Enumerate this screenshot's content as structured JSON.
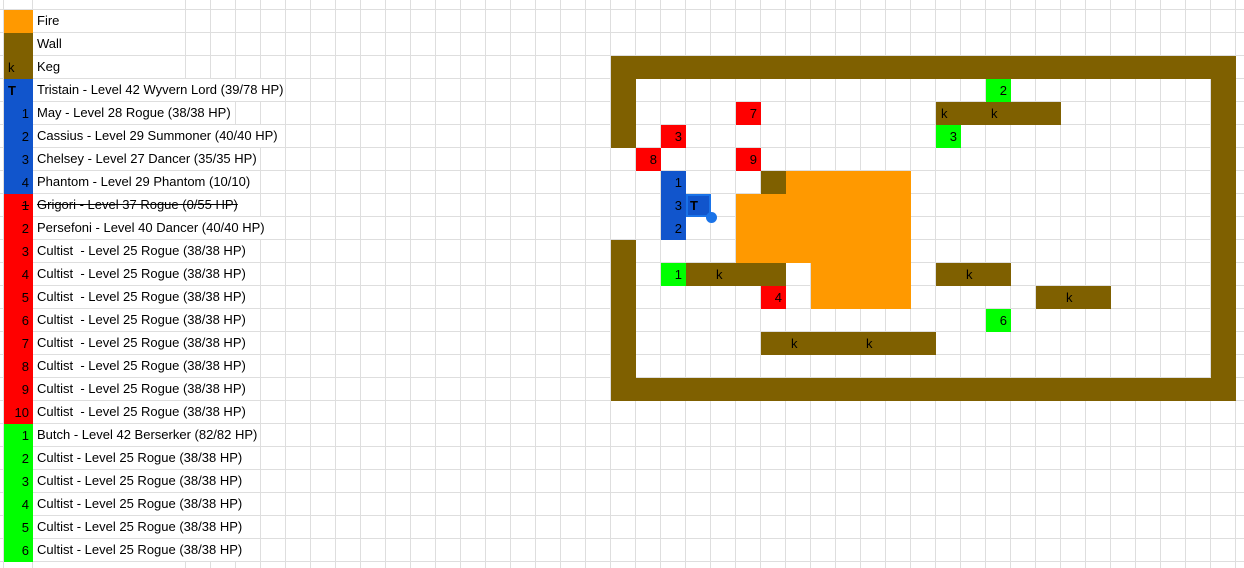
{
  "colors": {
    "fire": "#FF9900",
    "wall": "#7F6000",
    "blue_team": "#1155CC",
    "red_team": "#FF0000",
    "green_team": "#00FF00",
    "gridline": "#DEDEDE",
    "selection": "#1A73E8",
    "cell_text": "#000000",
    "background": "#FFFFFF"
  },
  "legend": {
    "rows": [
      {
        "swatch": "fire",
        "glyph": "",
        "label": "Fire"
      },
      {
        "swatch": "wall",
        "glyph": "",
        "label": "Wall"
      },
      {
        "swatch": "wall",
        "glyph": "k",
        "align": "left",
        "label": "Keg"
      },
      {
        "swatch": "blue_team",
        "glyph": "T",
        "align": "left",
        "bold": true,
        "label": "Tristain - Level 42 Wyvern Lord (39/78 HP)"
      },
      {
        "swatch": "blue_team",
        "glyph": "1",
        "label": "May - Level 28 Rogue (38/38 HP)"
      },
      {
        "swatch": "blue_team",
        "glyph": "2",
        "label": "Cassius - Level 29 Summoner (40/40 HP)"
      },
      {
        "swatch": "blue_team",
        "glyph": "3",
        "label": "Chelsey - Level 27 Dancer (35/35 HP)"
      },
      {
        "swatch": "blue_team",
        "glyph": "4",
        "label": "Phantom - Level 29 Phantom (10/10)"
      },
      {
        "swatch": "red_team",
        "glyph": "1",
        "strike": true,
        "label": "Grigori - Level 37 Rogue (0/55 HP)"
      },
      {
        "swatch": "red_team",
        "glyph": "2",
        "label": "Persefoni - Level 40 Dancer (40/40 HP)"
      },
      {
        "swatch": "red_team",
        "glyph": "3",
        "label": "Cultist  - Level 25 Rogue (38/38 HP)"
      },
      {
        "swatch": "red_team",
        "glyph": "4",
        "label": "Cultist  - Level 25 Rogue (38/38 HP)"
      },
      {
        "swatch": "red_team",
        "glyph": "5",
        "label": "Cultist  - Level 25 Rogue (38/38 HP)"
      },
      {
        "swatch": "red_team",
        "glyph": "6",
        "label": "Cultist  - Level 25 Rogue (38/38 HP)"
      },
      {
        "swatch": "red_team",
        "glyph": "7",
        "label": "Cultist  - Level 25 Rogue (38/38 HP)"
      },
      {
        "swatch": "red_team",
        "glyph": "8",
        "label": "Cultist  - Level 25 Rogue (38/38 HP)"
      },
      {
        "swatch": "red_team",
        "glyph": "9",
        "label": "Cultist  - Level 25 Rogue (38/38 HP)"
      },
      {
        "swatch": "red_team",
        "glyph": "10",
        "label": "Cultist  - Level 25 Rogue (38/38 HP)"
      },
      {
        "swatch": "green_team",
        "glyph": "1",
        "label": "Butch - Level 42 Berserker (82/82 HP)"
      },
      {
        "swatch": "green_team",
        "glyph": "2",
        "label": "Cultist - Level 25 Rogue (38/38 HP)"
      },
      {
        "swatch": "green_team",
        "glyph": "3",
        "label": "Cultist - Level 25 Rogue (38/38 HP)"
      },
      {
        "swatch": "green_team",
        "glyph": "4",
        "label": "Cultist - Level 25 Rogue (38/38 HP)"
      },
      {
        "swatch": "green_team",
        "glyph": "5",
        "label": "Cultist - Level 25 Rogue (38/38 HP)"
      },
      {
        "swatch": "green_team",
        "glyph": "6",
        "label": "Cultist - Level 25 Rogue (38/38 HP)"
      }
    ]
  },
  "map": {
    "left": 610,
    "top": 9,
    "cell_w": 25,
    "cell_h": 23,
    "wall_runs": [
      {
        "r": 3,
        "c1": 0,
        "c2": 24
      },
      {
        "r": 4,
        "c1": 0,
        "c2": 0
      },
      {
        "r": 4,
        "c1": 24,
        "c2": 24
      },
      {
        "r": 5,
        "c1": 0,
        "c2": 0
      },
      {
        "r": 5,
        "c1": 13,
        "c2": 17
      },
      {
        "r": 5,
        "c1": 24,
        "c2": 24
      },
      {
        "r": 6,
        "c1": 0,
        "c2": 0
      },
      {
        "r": 6,
        "c1": 24,
        "c2": 24
      },
      {
        "r": 7,
        "c1": 24,
        "c2": 24
      },
      {
        "r": 8,
        "c1": 6,
        "c2": 6
      },
      {
        "r": 8,
        "c1": 24,
        "c2": 24
      },
      {
        "r": 9,
        "c1": 24,
        "c2": 24
      },
      {
        "r": 10,
        "c1": 24,
        "c2": 24
      },
      {
        "r": 11,
        "c1": 0,
        "c2": 0
      },
      {
        "r": 11,
        "c1": 24,
        "c2": 24
      },
      {
        "r": 12,
        "c1": 0,
        "c2": 0
      },
      {
        "r": 12,
        "c1": 3,
        "c2": 6
      },
      {
        "r": 12,
        "c1": 13,
        "c2": 15
      },
      {
        "r": 12,
        "c1": 24,
        "c2": 24
      },
      {
        "r": 13,
        "c1": 0,
        "c2": 0
      },
      {
        "r": 13,
        "c1": 17,
        "c2": 19
      },
      {
        "r": 13,
        "c1": 24,
        "c2": 24
      },
      {
        "r": 14,
        "c1": 0,
        "c2": 0
      },
      {
        "r": 14,
        "c1": 24,
        "c2": 24
      },
      {
        "r": 15,
        "c1": 0,
        "c2": 0
      },
      {
        "r": 15,
        "c1": 6,
        "c2": 12
      },
      {
        "r": 15,
        "c1": 24,
        "c2": 24
      },
      {
        "r": 16,
        "c1": 0,
        "c2": 0
      },
      {
        "r": 16,
        "c1": 24,
        "c2": 24
      },
      {
        "r": 17,
        "c1": 0,
        "c2": 24
      }
    ],
    "fire_runs": [
      {
        "r": 8,
        "c1": 7,
        "c2": 11
      },
      {
        "r": 9,
        "c1": 5,
        "c2": 11
      },
      {
        "r": 10,
        "c1": 5,
        "c2": 11
      },
      {
        "r": 11,
        "c1": 5,
        "c2": 11
      },
      {
        "r": 12,
        "c1": 8,
        "c2": 11
      },
      {
        "r": 13,
        "c1": 8,
        "c2": 11
      }
    ],
    "kegs": [
      {
        "r": 5,
        "c": 13,
        "label": "k"
      },
      {
        "r": 5,
        "c": 15,
        "label": "k"
      },
      {
        "r": 12,
        "c": 4,
        "label": "k"
      },
      {
        "r": 12,
        "c": 14,
        "label": "k"
      },
      {
        "r": 13,
        "c": 18,
        "label": "k"
      },
      {
        "r": 15,
        "c": 7,
        "label": "k"
      },
      {
        "r": 15,
        "c": 10,
        "label": "k"
      }
    ],
    "units": [
      {
        "r": 5,
        "c": 5,
        "team": "red",
        "label": "7"
      },
      {
        "r": 6,
        "c": 2,
        "team": "red",
        "label": "3"
      },
      {
        "r": 7,
        "c": 1,
        "team": "red",
        "label": "8"
      },
      {
        "r": 7,
        "c": 5,
        "team": "red",
        "label": "9"
      },
      {
        "r": 13,
        "c": 6,
        "team": "red",
        "label": "4"
      },
      {
        "r": 8,
        "c": 2,
        "team": "blue",
        "label": "1"
      },
      {
        "r": 9,
        "c": 2,
        "team": "blue",
        "label": "3"
      },
      {
        "r": 9,
        "c": 3,
        "team": "blue",
        "label": "T",
        "bold": true,
        "selected": true
      },
      {
        "r": 10,
        "c": 2,
        "team": "blue",
        "label": "2"
      },
      {
        "r": 4,
        "c": 15,
        "team": "green",
        "label": "2"
      },
      {
        "r": 6,
        "c": 13,
        "team": "green",
        "label": "3"
      },
      {
        "r": 12,
        "c": 2,
        "team": "green",
        "label": "1"
      },
      {
        "r": 14,
        "c": 15,
        "team": "green",
        "label": "6"
      }
    ]
  }
}
